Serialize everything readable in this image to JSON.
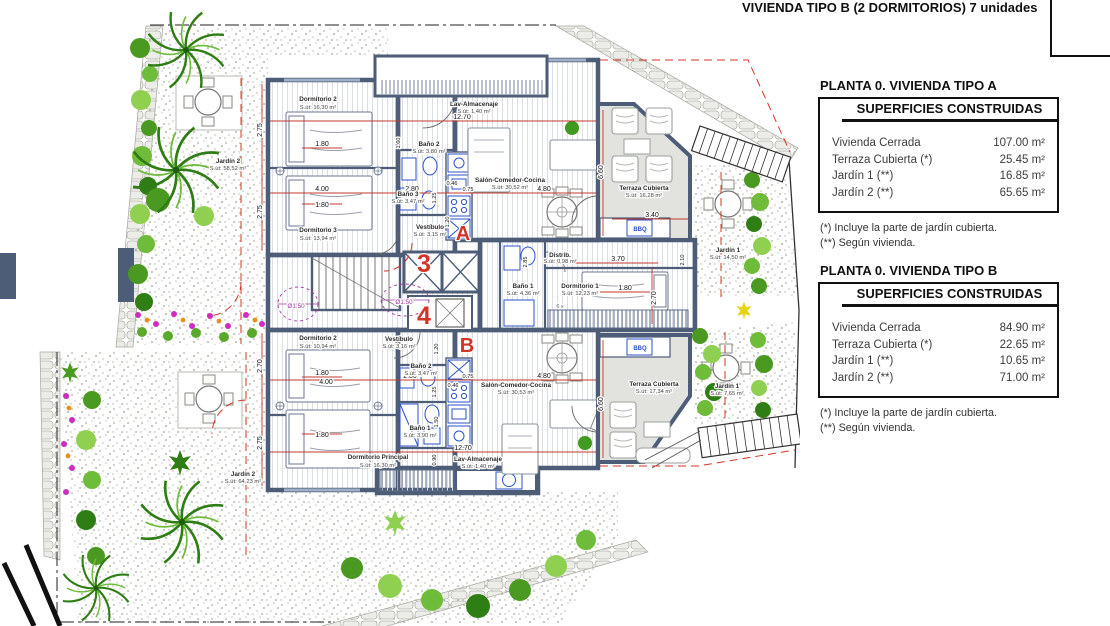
{
  "header": {
    "title": "VIVIENDA TIPO B (2 DORMITORIOS) 7 unidades"
  },
  "panels": [
    {
      "heading": "PLANTA 0. VIVIENDA TIPO A",
      "table_title": "SUPERFICIES CONSTRUIDAS",
      "rows": [
        {
          "label": "Vivienda Cerrada",
          "value": "107.00 m²"
        },
        {
          "label": "Terraza Cubierta  (*)",
          "value": "25.45 m²"
        },
        {
          "label": "Jardín 1 (**)",
          "value": "16.85 m²"
        },
        {
          "label": "Jardín 2 (**)",
          "value": "65.65 m²"
        }
      ],
      "notes": [
        "(*)  Incluye la parte de jardín cubierta.",
        "(**) Según vivienda."
      ]
    },
    {
      "heading": "PLANTA 0. VIVIENDA TIPO B",
      "table_title": "SUPERFICIES CONSTRUIDAS",
      "rows": [
        {
          "label": "Vivienda Cerrada",
          "value": "84.90 m²"
        },
        {
          "label": "Terraza Cubierta (*)",
          "value": "22.65 m²"
        },
        {
          "label": "Jardín 1 (**)",
          "value": "10.65 m²"
        },
        {
          "label": "Jardín 2 (**)",
          "value": "71.00 m²"
        }
      ],
      "notes": [
        "(*) Incluye la parte de jardín cubierta.",
        "(**) Según vivienda."
      ]
    }
  ],
  "plan": {
    "rooms": {
      "a_dorm2": {
        "name": "Dormitorio 2",
        "area": "S.út: 16,30 m²"
      },
      "a_dorm3": {
        "name": "Dormitorio 3",
        "area": "S.út: 13,94 m²"
      },
      "a_bano2": {
        "name": "Baño 2",
        "area": "S.út: 3,80 m²"
      },
      "a_bano3": {
        "name": "Baño 3",
        "area": "S.út: 3,47 m²"
      },
      "a_vest": {
        "name": "Vestíbulo",
        "area": "S.út: 3,15 m²"
      },
      "a_lav": {
        "name": "Lav-Almacenaje",
        "area": "S.út: 1,40 m²"
      },
      "a_salon": {
        "name": "Salón-Comedor-Cocina",
        "area": "S.út: 30,52 m²"
      },
      "a_terraza": {
        "name": "Terraza Cubierta",
        "area": "S.út: 16,28 m²"
      },
      "a_distrib": {
        "name": "Distrib.",
        "area": "S.út: 0,98 m²"
      },
      "a_bano1": {
        "name": "Baño 1",
        "area": "S.út: 4,36 m²"
      },
      "a_dorm1": {
        "name": "Dormitorio 1",
        "area": "S.út: 12,23 m²"
      },
      "a_jardin1": {
        "name": "Jardín 1",
        "area": "S.út: 14,50 m²"
      },
      "a_jardin2": {
        "name": "Jardín 2",
        "area": "S.út: 58,52 m²"
      },
      "b_dorm2": {
        "name": "Dormitorio 2",
        "area": "S.út: 10,94 m²"
      },
      "b_vest": {
        "name": "Vestíbulo",
        "area": "S.út: 3,16 m²"
      },
      "b_bano2": {
        "name": "Baño 2",
        "area": "S.út: 3,47 m²"
      },
      "b_bano1": {
        "name": "Baño 1",
        "area": "S.út: 3,90 m²"
      },
      "b_dormp": {
        "name": "Dormitorio Principal",
        "area": "S.út: 16,30 m²"
      },
      "b_salon": {
        "name": "Salón-Comedor-Cocina",
        "area": "S.út: 30,53 m²"
      },
      "b_lav": {
        "name": "Lav-Almacenaje",
        "area": "S.út: 1,40 m²"
      },
      "b_terraza": {
        "name": "Terraza Cubierta",
        "area": "S.út: 17,34 m²"
      },
      "b_jardin1": {
        "name": "Jardín 1",
        "area": "S.út: 7,65 m²"
      },
      "b_jardin2": {
        "name": "Jardín 2",
        "area": "S.út: 64,23 m²"
      }
    },
    "dims": {
      "d046": "0.46",
      "d075": "0.75",
      "d090": "0.90",
      "d120": "1.20",
      "d125": "1.25",
      "d150": "1.50",
      "d160": "1.60",
      "d180": "1.80",
      "d210": "2.10",
      "d270": "2.70",
      "d275": "2.75",
      "d280": "2.80",
      "d285": "2.85",
      "d340": "3.40",
      "d370": "3.70",
      "d400": "4.00",
      "d480": "4.80",
      "d660": "6.60",
      "d1270": "12.70"
    },
    "markers": {
      "unit_a_letter": "A",
      "unit_b_letter": "B",
      "unit3": "3",
      "unit4": "4",
      "circle_dim": "Ø1.50",
      "bbq": "BBQ",
      "stair_note": "6 x"
    },
    "colors": {
      "wall": "#4d5c77",
      "accent_red": "#d43425",
      "dim_red": "#c0392b",
      "fixture_blue": "#2d52c8",
      "terrace_gray": "#e2e2df",
      "garden_green": "#5aa82c"
    }
  }
}
